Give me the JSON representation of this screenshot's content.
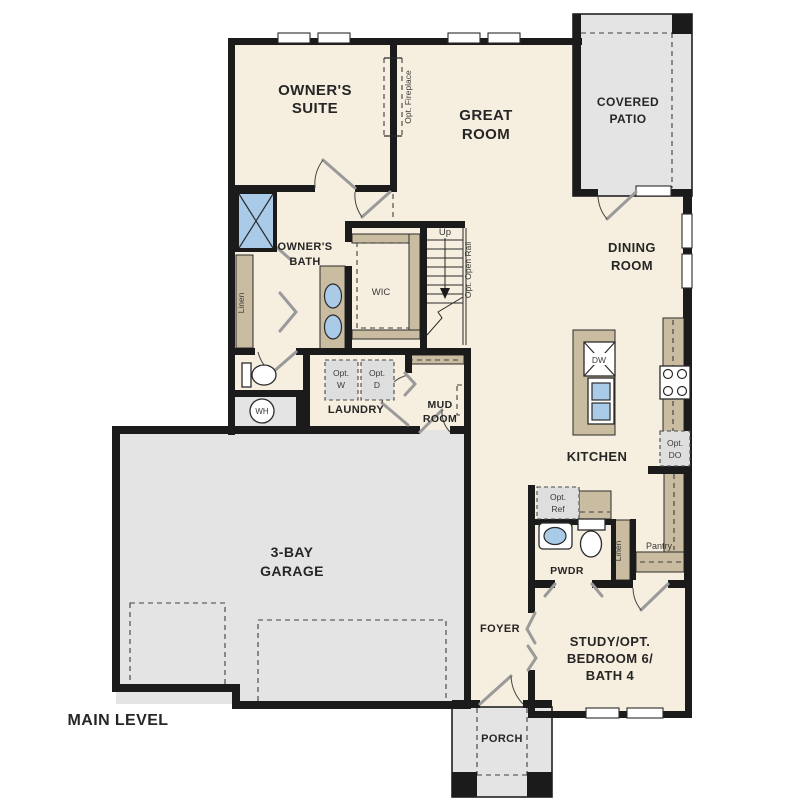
{
  "plan": {
    "level_label": "MAIN LEVEL"
  },
  "colors": {
    "background": "#ffffff",
    "floor": "#f6eede",
    "hardscape": "#e4e4e4",
    "wall": "#1b1b1b",
    "cabinet": "#c9bca0",
    "fixture_blue": "#a9cbe8",
    "appliance_gray": "#dedede",
    "text": "#2b2b2b"
  },
  "rooms": {
    "owners_suite": {
      "line1": "OWNER'S",
      "line2": "SUITE"
    },
    "great_room": {
      "line1": "GREAT",
      "line2": "ROOM"
    },
    "covered_patio": {
      "line1": "COVERED",
      "line2": "PATIO"
    },
    "dining_room": {
      "line1": "DINING",
      "line2": "ROOM"
    },
    "owners_bath": {
      "line1": "OWNER'S",
      "line2": "BATH"
    },
    "wic": {
      "label": "WIC"
    },
    "laundry": {
      "label": "LAUNDRY"
    },
    "mud_room": {
      "line1": "MUD",
      "line2": "ROOM"
    },
    "kitchen": {
      "label": "KITCHEN"
    },
    "pwdr": {
      "label": "PWDR"
    },
    "pantry": {
      "label": "Pantry"
    },
    "garage": {
      "line1": "3-BAY",
      "line2": "GARAGE"
    },
    "foyer": {
      "label": "FOYER"
    },
    "study": {
      "line1": "STUDY/OPT.",
      "line2": "BEDROOM 6/",
      "line3": "BATH 4"
    },
    "porch": {
      "label": "PORCH"
    }
  },
  "annotations": {
    "up": "Up",
    "opt_open_rail": "Opt. Open Rail",
    "opt_fireplace": "Opt. Fireplace",
    "linen_left": "Linen",
    "linen_right": "Linen",
    "wh": "WH",
    "dw": "DW"
  },
  "appliances": {
    "opt_w": {
      "line1": "Opt.",
      "line2": "W"
    },
    "opt_d": {
      "line1": "Opt.",
      "line2": "D"
    },
    "opt_do": {
      "line1": "Opt.",
      "line2": "DO"
    },
    "opt_ref": {
      "line1": "Opt.",
      "line2": "Ref"
    }
  }
}
